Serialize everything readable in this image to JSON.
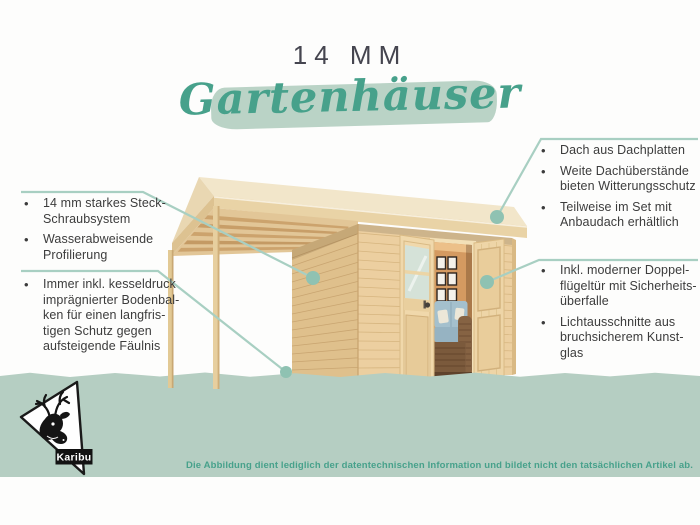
{
  "header": {
    "kicker": "14 MM",
    "title": "Gartenhäuser"
  },
  "bullet_glyph": "•",
  "callouts": {
    "top_left": {
      "items": [
        {
          "text": "14 mm starkes Steck-\nSchraubsystem"
        },
        {
          "text": "Wasserabweisende\nProfilierung"
        }
      ]
    },
    "bottom_left": {
      "items": [
        {
          "text": "Immer inkl. kesseldruck\nimprägnierter Bodenbal-\nken für einen langfris-\ntigen Schutz gegen\naufsteigende Fäulnis"
        }
      ]
    },
    "top_right": {
      "items": [
        {
          "text": "Dach aus Dachplatten"
        },
        {
          "text": "Weite Dachüberstände\nbieten Witterungsschutz"
        },
        {
          "text": "Teilweise im Set mit\nAnbaudach erhältlich"
        }
      ]
    },
    "bottom_right": {
      "items": [
        {
          "text": "Inkl. moderner Doppel-\nflügeltür mit Sicherheits-\nüberfalle"
        },
        {
          "text": "Lichtausschnitte aus\nbruchsicherem Kunst-\nglas"
        }
      ]
    }
  },
  "footer": {
    "disclaimer": "Die Abbildung dient lediglich der datentechnischen Information und bildet nicht den tatsächlichen Artikel ab."
  },
  "brand": {
    "logo_label": "Karibu"
  },
  "colors": {
    "accent_teal": "#47a18b",
    "title_ink": "#45454f",
    "ink": "#3c3c3c",
    "line_sage": "#a8cfc2",
    "dot_sage": "#8fc2b2",
    "ground_sage": "#b5cec2",
    "band_sage": "#bad3c6"
  }
}
